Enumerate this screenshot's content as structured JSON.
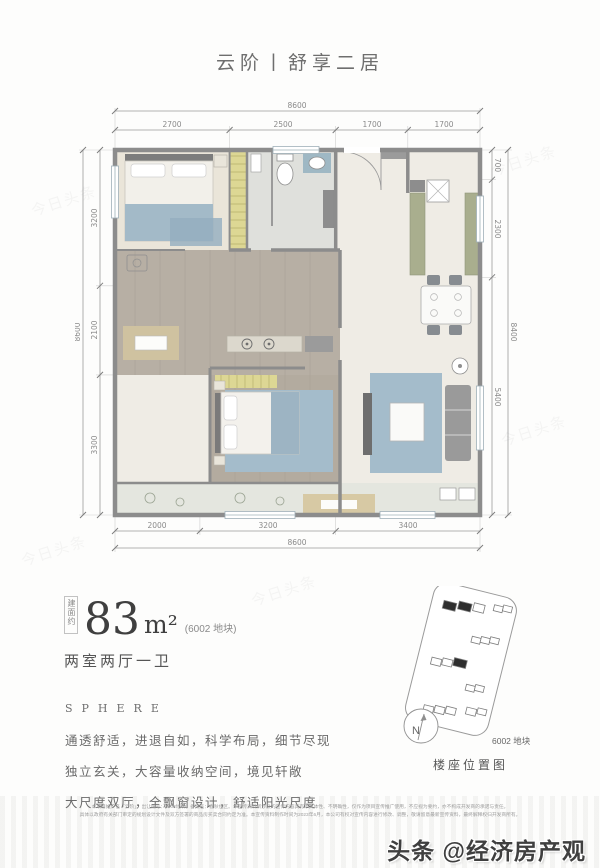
{
  "page": {
    "title": "云阶丨舒享二居"
  },
  "plan": {
    "dims": {
      "top": {
        "total": "8600",
        "segments": [
          "2700",
          "2500",
          "1700",
          "1700"
        ]
      },
      "left": {
        "total": "8600",
        "segments": [
          "3200",
          "2100",
          "3300"
        ]
      },
      "right": {
        "total": "8400",
        "segments": [
          "700",
          "2300",
          "5400"
        ]
      },
      "bottom": {
        "total": "8600",
        "segments": [
          "2000",
          "3200",
          "3400"
        ]
      }
    }
  },
  "info": {
    "area_prefix": "建面约",
    "area_value": "83",
    "area_unit": "m²",
    "area_note": "(6002 地块)",
    "layout": "两室两厅一卫",
    "tagline": "SPHERE",
    "desc_lines": [
      "通透舒适，进退自如，科学布局，细节尽现",
      "独立玄关，大容量收纳空间，境见轩敞",
      "大尺度双厅，全飘窗设计，舒适阳光尺度"
    ]
  },
  "location": {
    "parcel_label": "6002 地块",
    "caption": "楼座位置图",
    "compass_n": "N"
  },
  "footer": {
    "disclaimer_line1": "本项目推广名「云阶」，出让编号：6002地块，备案名：春秋住区。本宣传资料所涉及的宣传内容具有不具体性、不明确性，仅作为项目宣传推广使用，不应视为要约，亦不构成开发商的承诺与责任。",
    "disclaimer_line2": "具体以政府有关部门审定的规划设计文件及双方签署的商品房买卖合同约定为准。本宣传资料制作时间为2023年6月，本公司有权对宣传内容进行修改、调整，敬请留意最新宣传资料，最终解释权归开发商所有。",
    "watermark": "头条 @经济房产观"
  },
  "colors": {
    "wall": "#8c8c8c",
    "wood_gray": "#b7afa4",
    "floor_beige": "#eae5d9",
    "rug_blue": "#a4bccb",
    "cabinet_green": "#a9ae8e",
    "wardrobe_yellow": "#ddd794",
    "bay_beige": "#d7c9a4"
  }
}
